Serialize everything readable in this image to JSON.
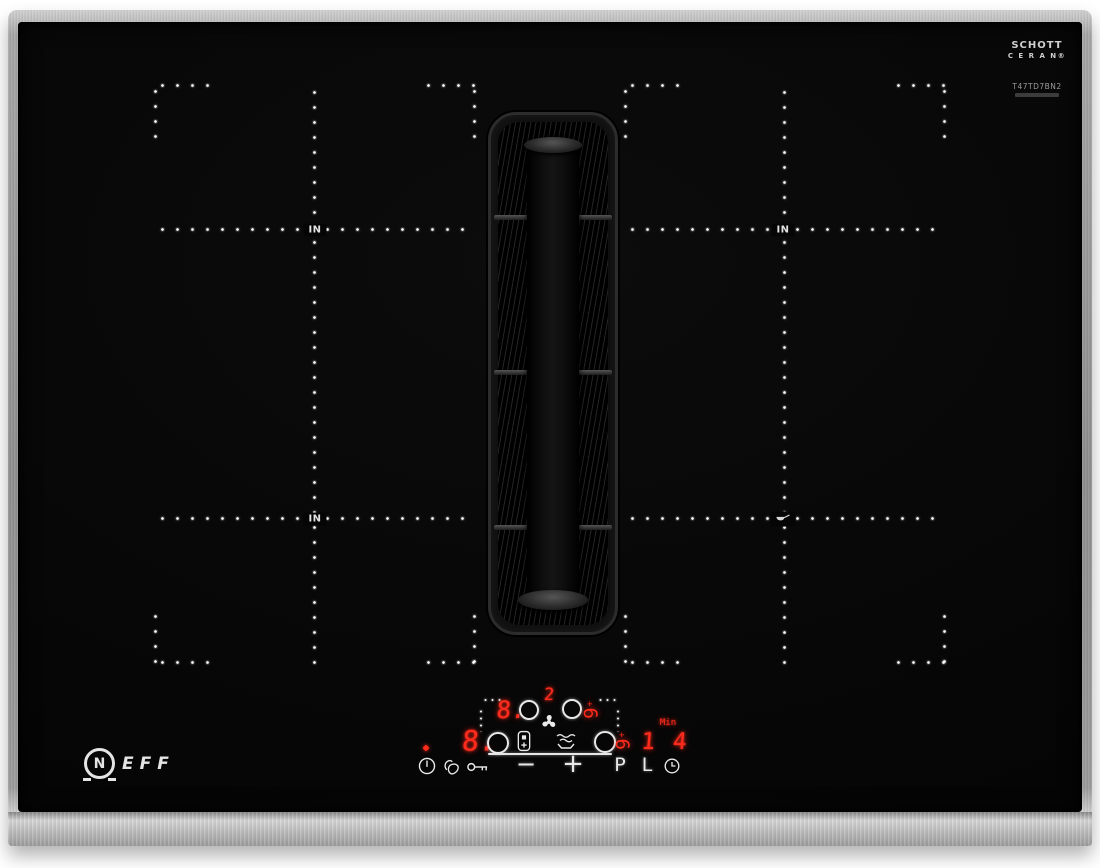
{
  "brand": {
    "emblem_letter": "N",
    "wordmark": "EFF"
  },
  "glass_branding": {
    "schott_line1": "SCHOTT",
    "schott_line2": "C E R A N®",
    "model": "T47TD7BN2"
  },
  "zone_marks": {
    "left_back": "IN",
    "left_front": "IN",
    "right_back": "IN"
  },
  "zone_displays": {
    "left_back": "8.",
    "left_front": "8.",
    "right_back": "6",
    "right_back_mark": "+",
    "right_front": "6",
    "right_front_mark": "+"
  },
  "vent_display": {
    "fan_level": "2"
  },
  "timer": {
    "unit_label": "Min",
    "value": "1 4"
  },
  "control_labels": {
    "minus": "−",
    "plus": "+",
    "power_boost": "P",
    "lock": "L"
  },
  "icons": {
    "fan": "fan-icon",
    "combine_zones": "combine-zones-icon",
    "vent_steam": "vent-steam-icon",
    "power": "power-icon",
    "wipe_protection": "wipe-protection-icon",
    "child_lock_key": "key-icon",
    "timer_clock": "clock-icon",
    "pan_sensor": "pan-icon"
  },
  "colors": {
    "led_red": "#ff2b1d",
    "glyph_white": "#e9e9e9",
    "steel": "#b6b6b6",
    "glass_black": "#060606"
  }
}
